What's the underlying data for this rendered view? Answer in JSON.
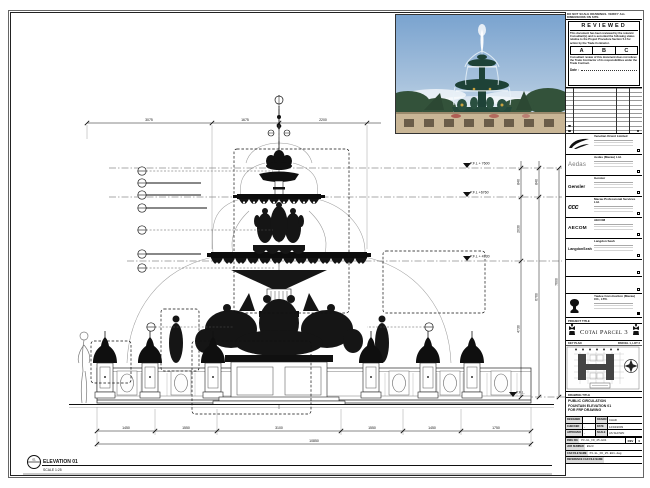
{
  "colors": {
    "paper": "#ffffff",
    "line": "#1a1a1a",
    "sky_top": "#7aa3cf",
    "sky_bottom": "#c5d8ea",
    "foliage": "#33523a",
    "fountain_bronze": "#1e4237",
    "stone": "#c9b696",
    "gold_accent": "#c9a23f"
  },
  "cad": {
    "elevation_tag": "01",
    "elevation_label": "ELEVATION 01",
    "elevation_scale": "SCALE 1:25",
    "levels": [
      "P.F.L + 7600",
      "P.F.L +6760",
      "P.F.L + 4730",
      "P.F.L."
    ],
    "dims_top": [
      "3075",
      "1675",
      "2200"
    ],
    "dims_right": [
      "840",
      "2030",
      "4730",
      "840",
      "6760",
      "7600"
    ],
    "dims_bottom": [
      "1450",
      "1550",
      "3100",
      "1550",
      "1450",
      "1750"
    ],
    "dim_overall": "10850"
  },
  "titleblock": {
    "note": "DO NOT SCALE DRAWINGS. VERIFY ALL DIMENSIONS ON SITE.",
    "reviewed": {
      "title": "REVIEWED",
      "para1": "This document has been reviewed by the relevant Consultant(s) and is accorded the following status relative to the Project Procedure Section 5.4 for action by the Trade Contractor.",
      "options": [
        "A",
        "B",
        "C"
      ],
      "para2": "Consultant review of this document does not relieve the Trade Contractor of its responsibilities under the Trade Contract.",
      "date_label": "Date :"
    },
    "consultants": [
      {
        "name": "Venetian Orient Limited"
      },
      {
        "name": "Aedas (Macau) Ltd.",
        "logo_text": "Aedas"
      },
      {
        "name": "Gensler",
        "logo_text": "Gensler"
      },
      {
        "name": "Macau Professional Services Ltd.",
        "logo_text": "ccc"
      },
      {
        "name": "AECOM",
        "logo_text": "AECOM"
      },
      {
        "name": "Langdon Seah",
        "logo_text": "LangdonSeah"
      },
      {
        "name": ""
      },
      {
        "name": ""
      },
      {
        "name": "Yaulee Construction (Macau) CO., LTD."
      }
    ],
    "project": {
      "label": "PROJECT TITLE",
      "title": "Cotai Parcel 3"
    },
    "key_plan": {
      "label": "KEY PLAN",
      "sublabel": "PARCEL 1, LOT 2"
    },
    "drawing": {
      "label": "DRAWING TITLE",
      "line1": "PUBLIC CIRCULATION",
      "line2": "FOUNTAIN ELEVATION 01",
      "line3": "FOR FRP DRAWING"
    },
    "info": {
      "designed_label": "DESIGNED",
      "designed": "",
      "drawn_label": "DRAWN",
      "drawn": "CHAD",
      "checked_label": "CHECKED",
      "checked": "-",
      "date_label": "DATE",
      "date": "12/04/2009",
      "approved_label": "APPROVED",
      "approved": "-",
      "scale_label": "SCALE",
      "scale": "AS SHOWN",
      "dwg_label": "DWG NO.",
      "dwg": "P3-GL_FD_25-E01",
      "rev_label": "REV",
      "rev": "0",
      "job_label": "JOB NUMBER",
      "job": "B123",
      "cad_label": "CAD FILE NAME",
      "cad_file": "P3-GL_FD_25-E01.dwg",
      "ref_label": "REFERENCE CAD FILE NAME"
    }
  }
}
